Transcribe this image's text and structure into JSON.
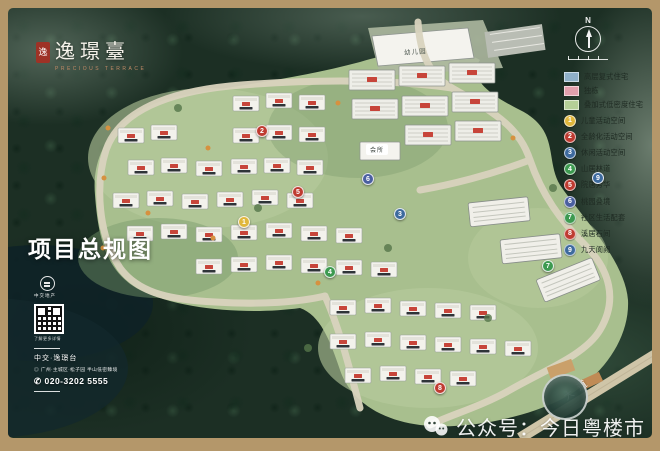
{
  "logo": {
    "seal_char": "逸",
    "name": "逸璟臺",
    "subtitle": "PRECIOUS TERRACE"
  },
  "title": "项目总规图",
  "compass": {
    "north": "N"
  },
  "map_labels": {
    "kindergarten": "幼儿园",
    "clubhouse": "会所",
    "road": "大道"
  },
  "legend": {
    "area_types": [
      {
        "label": "高层复式住宅",
        "color": "#8fb0c9"
      },
      {
        "label": "独栋",
        "color": "#e2a0ad"
      },
      {
        "label": "叠加式低密度住宅",
        "color": "#b5cf97"
      }
    ],
    "markers": [
      {
        "n": "1",
        "label": "儿童活动空间",
        "color": "#e0b73c"
      },
      {
        "n": "2",
        "label": "全龄化活动空间",
        "color": "#bf3b31"
      },
      {
        "n": "3",
        "label": "休闲活动空间",
        "color": "#3d6a9e"
      },
      {
        "n": "4",
        "label": "山居林道",
        "color": "#3d9a50"
      },
      {
        "n": "5",
        "label": "院居芳华",
        "color": "#bf3b31"
      },
      {
        "n": "6",
        "label": "桃园叠境",
        "color": "#4a5fa0"
      },
      {
        "n": "7",
        "label": "社区生活配套",
        "color": "#3d9a50"
      },
      {
        "n": "8",
        "label": "溪居石间",
        "color": "#bf3b31"
      },
      {
        "n": "9",
        "label": "九天阆阙",
        "color": "#3d6a9e"
      }
    ]
  },
  "developer": {
    "logo_caption": "中交地产",
    "qr_caption": "了解更多详情"
  },
  "contact": {
    "project": "中交·逸璟台",
    "address": "广州·主城区·松子园 半山低密臻境",
    "phone": "020-3202 5555"
  },
  "icons": {
    "location": "◎",
    "phone": "✆"
  },
  "watermark": {
    "wechat_label": "公众号：今日粤楼市"
  }
}
